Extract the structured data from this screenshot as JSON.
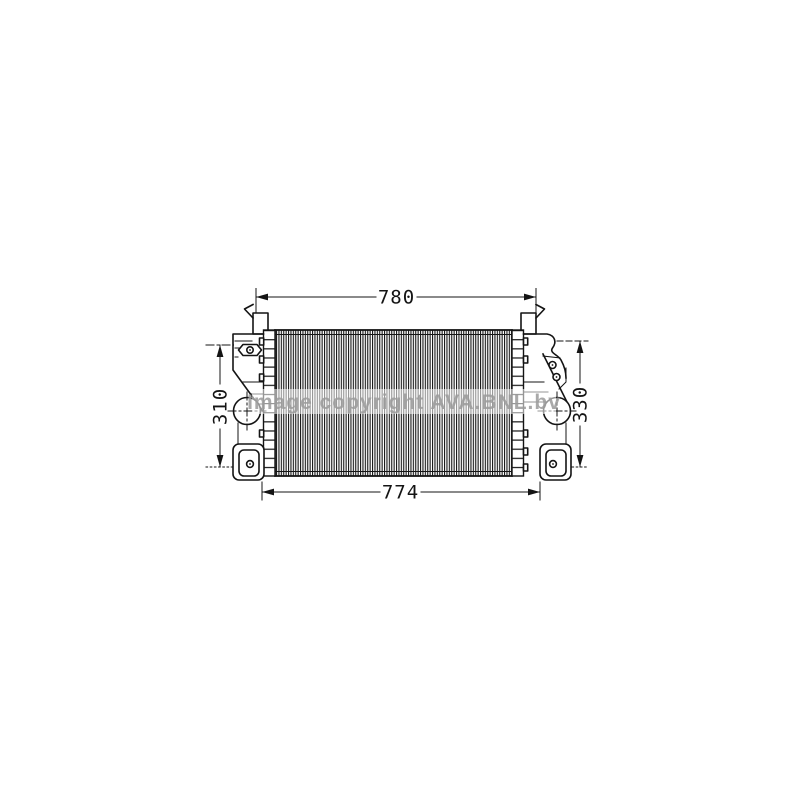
{
  "page": {
    "background_color": "#ffffff"
  },
  "drawing": {
    "line_color": "#141414",
    "dimensions": {
      "top_width": "780",
      "bottom_width": "774",
      "left_height": "310",
      "right_height": "330"
    },
    "watermark": {
      "text": "Image copyright AVA.BNL.bv",
      "color": "#9b9b9b"
    }
  }
}
